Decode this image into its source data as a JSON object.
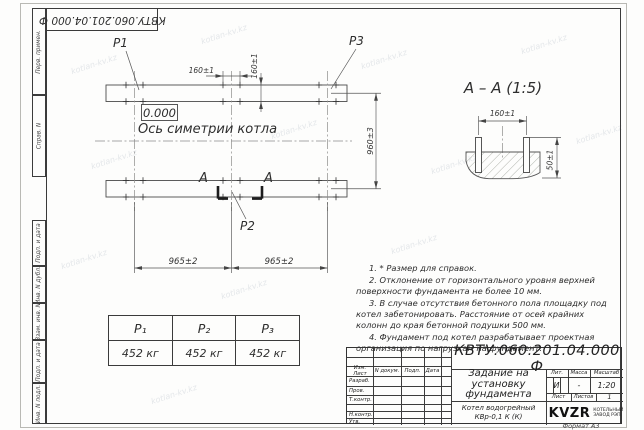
{
  "watermark": "kotlan-kv.kz",
  "frame": {
    "doc_number_rotated": "КВТУ.060.201.04.000 Ф",
    "format_label": "Формат А3",
    "sidebar_labels": [
      "Перв. примен.",
      "Справ. N",
      "Подп. и дата",
      "Инв. N дубл.",
      "Взам. инв. N",
      "Подп. и дата",
      "Инв. N подл."
    ]
  },
  "plan": {
    "point_labels": {
      "p1": "P1",
      "p2": "P2",
      "p3": "P3"
    },
    "elevation_mark": "0.000",
    "axis_label": "Ось симетрии котла",
    "section_letter_left": "А",
    "section_letter_right": "А",
    "dim_bolt_horizontal": "160±1",
    "dim_bolt_vertical": "160±1",
    "dim_height": "960±3",
    "dim_span_left": "965±2",
    "dim_span_right": "965±2"
  },
  "detail": {
    "title": "А – А (1:5)",
    "dim_bolt_spacing": "160±1",
    "dim_pad_height": "50±1"
  },
  "notes": [
    "1. * Размер для справок.",
    "2. Отклонение от горизонтального уровня верхней поверхности фундамента не более 10 мм.",
    "3. В случае отсутствия бетонного пола площадку под котел забетонировать. Расстояние от осей крайних колонн до края бетонной подушки 500 мм.",
    "4. Фундамент под котел разрабатывает проектная организация по нагрузкам на фундамент."
  ],
  "load_table": {
    "headers": [
      "P₁",
      "P₂",
      "P₃"
    ],
    "values": [
      "452 кг",
      "452 кг",
      "452 кг"
    ]
  },
  "title_block": {
    "doc_number": "КВТУ.060.201.04.000 Ф",
    "title": "Задание на установку фундамента",
    "product_line1": "Котел водогрейный",
    "product_line2": "КВр-0,1 К (К)",
    "header_cols": [
      "Изм. Лист",
      "N докум.",
      "Подп.",
      "Дата"
    ],
    "row_labels": [
      "Разраб.",
      "Пров.",
      "Т.контр.",
      "Н.контр.",
      "Утв."
    ],
    "lit_label": "Лит.",
    "lit_value": "И",
    "mass_label": "Масса",
    "mass_value": "-",
    "scale_label": "Масштаб",
    "scale_value": "1:20",
    "sheet_label": "Лист",
    "sheets_label": "Листов",
    "sheets_value": "1",
    "logo_text": "KVZR",
    "logo_caption_line1": "КОТЕЛЬНЫЙ",
    "logo_caption_line2": "ЗАВОД РЭП"
  }
}
